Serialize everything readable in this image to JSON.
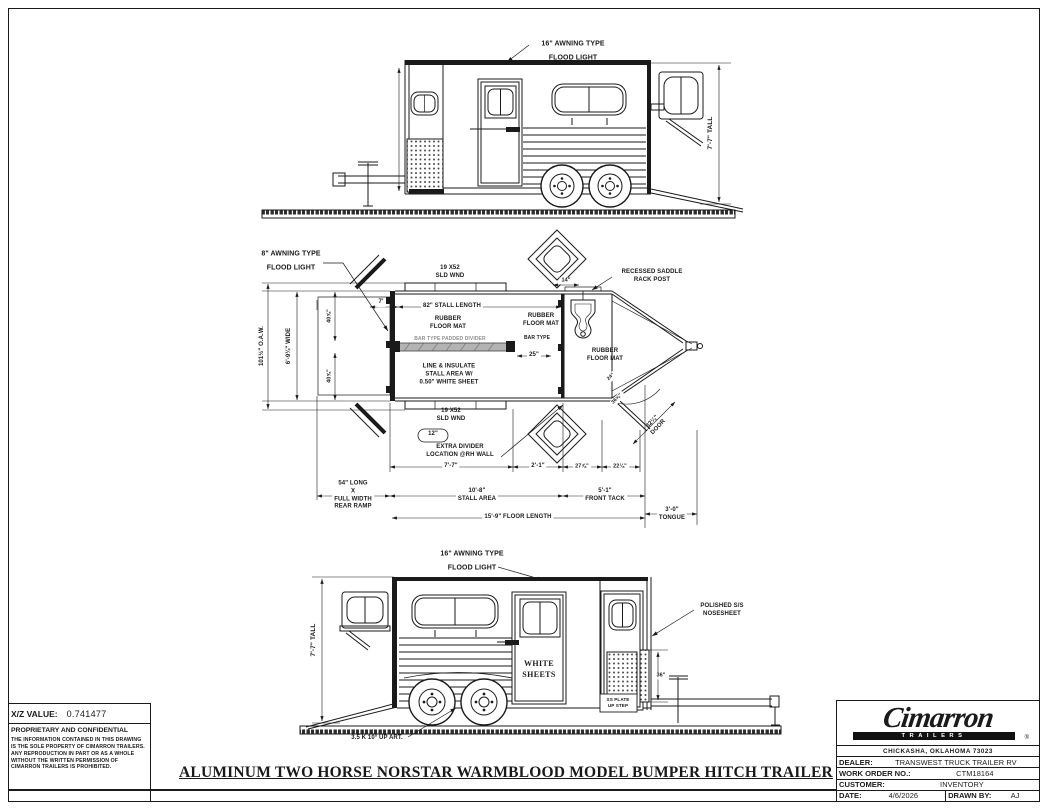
{
  "sheet": {
    "title": "ALUMINUM TWO HORSE NORSTAR WARMBLOOD MODEL BUMPER HITCH TRAILER"
  },
  "side_view_top": {
    "awning_label": "16\" AWNING TYPE\nFLOOD LIGHT",
    "height_dim": "7'-7\" TALL"
  },
  "plan_view": {
    "awning_label": "8\" AWNING TYPE\nFLOOD LIGHT",
    "window_label_top": "19 X52\nSLD WND",
    "window_label_bottom": "19 X52\nSLD WND",
    "overall_width_dim": "101½\" O.A.W.",
    "inside_width_dim": "6'-9¼\" WIDE",
    "half_width_top_dim": "40⅝\"",
    "half_width_bottom_dim": "40⅝\"",
    "rear_offset_dim": "7'",
    "stall_length_dim": "82\" STALL LENGTH",
    "rubber_mat_rear": "RUBBER\nFLOOR MAT",
    "divider_label": "BAR TYPE PADDED DIVIDER",
    "insulate_note": "LINE & INSULATE\nSTALL AREA W/\n0.50\" WHITE SHEET",
    "rubber_mat_mid": "RUBBER\nFLOOR MAT",
    "bar_type_label": "BAR TYPE",
    "stall_width_dim": "25\"",
    "rubber_mat_front": "RUBBER\nFLOOR MAT",
    "saddle_rack_label": "RECESSED SADDLE\nRACK POST",
    "rack_offset_dim": "14\"",
    "extra_divider_size": "12\"",
    "extra_divider_note": "EXTRA DIVIDER\nLOCATION @RH WALL",
    "dim_7_7": "7'-7\"",
    "dim_2_1": "2'-1\"",
    "dim_27_78": "27⅞\"",
    "dim_22_18": "22⅛\"",
    "ramp_note": "54\" LONG\nX\nFULL WIDTH\nREAR RAMP",
    "stall_area_dim": "10'-8\"\nSTALL AREA",
    "front_tack_dim": "5'-1\"\nFRONT TACK",
    "floor_length_dim": "15'-9\" FLOOR LENGTH",
    "tongue_dim": "3'-0\"\nTONGUE",
    "door_dim": "32¼\"\nDOOR",
    "step_dim_a": "24\"",
    "step_dim_b": "36⅝\""
  },
  "side_view_bottom": {
    "awning_label": "16\" AWNING TYPE\nFLOOD LIGHT",
    "height_dim": "7'-7\" TALL",
    "door_note": "WHITE\nSHEETS",
    "nose_label": "POLISHED S/S\nNOSESHEET",
    "nose_height_dim": "36\"",
    "step_label": "SS PLATE\nUP STEP",
    "axle_label": "3.5 K 10° UP ART."
  },
  "info_block": {
    "xz_label": "X/Z VALUE:",
    "xz_value": "0.741477",
    "confidential_title": "PROPRIETARY AND CONFIDENTIAL",
    "confidential_body": "THE INFORMATION CONTAINED IN THIS DRAWING IS THE SOLE PROPERTY OF CIMARRON TRAILERS. ANY REPRODUCTION IN PART OR AS A WHOLE WITHOUT THE WRITTEN PERMISSION OF CIMARRON TRAILERS IS PROHIBITED."
  },
  "title_block": {
    "brand": "Cimarron",
    "brand_sub": "TRAILERS",
    "brand_mark": "®",
    "address": "CHICKASHA, OKLAHOMA 73023",
    "dealer_label": "DEALER:",
    "dealer_value": "TRANSWEST TRUCK TRAILER RV",
    "work_order_label": "WORK ORDER NO.:",
    "work_order_value": "CTM18164",
    "customer_label": "CUSTOMER:",
    "customer_value": "INVENTORY",
    "date_label": "DATE:",
    "date_value": "4/6/2026",
    "drawn_by_label": "DRAWN BY:",
    "drawn_by_value": "AJ"
  },
  "colors": {
    "line": "#1a1a1a",
    "divider_gray": "#b3b3b3",
    "background": "#ffffff"
  }
}
